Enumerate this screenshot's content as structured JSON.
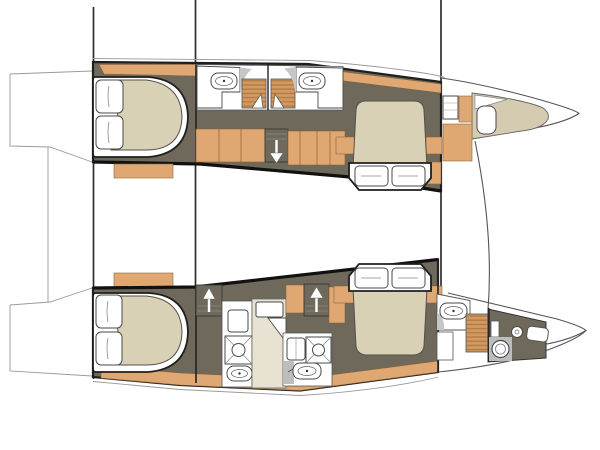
{
  "figure": {
    "kind": "catamaran-interior-floorplan",
    "orientation": "bow-right"
  },
  "palette": {
    "white": "#ffffff",
    "outline": "#1f1f1f",
    "deck": "#9a9a9a",
    "wood": "#dfa873",
    "wood_edge": "#8a6337",
    "wood_dark": "#b37c44",
    "wood_mid": "#d29a62",
    "olive": "#6e695a",
    "mattress": "#d9d1b6",
    "cream": "#e7e2d2",
    "sunpad": "#d4cbb0",
    "counter": "#c6c6c6",
    "gray_floor": "#bdbdbd",
    "fixture": "#4a4a4a"
  },
  "icons": {
    "stairs_down": "arrow-down",
    "stairs_up": "arrow-up",
    "sink": "oval-basin-with-faucet-dot",
    "shower_grate": "teak-grate-stripes",
    "shower_tray": "square-x-with-drain-circle",
    "toilet": "double-circle-bowl",
    "bed": "mattress-with-two-pillows",
    "hatch": "rounded-rect"
  }
}
